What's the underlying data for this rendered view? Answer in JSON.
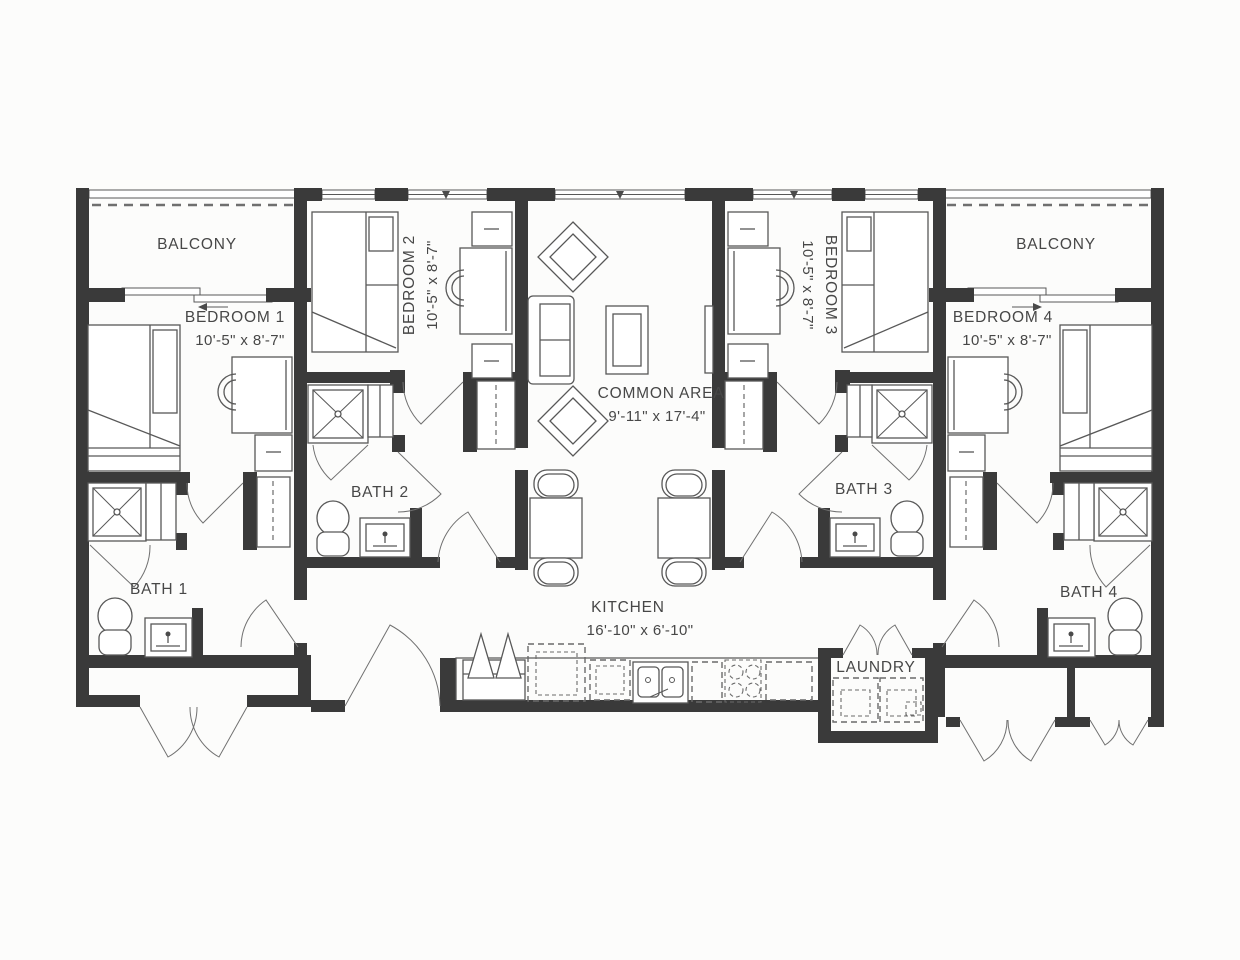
{
  "plan": {
    "title": "4-bedroom unit floor plan",
    "rooms": {
      "balcony_left": {
        "name": "BALCONY"
      },
      "balcony_right": {
        "name": "BALCONY"
      },
      "bedroom1": {
        "name": "BEDROOM 1",
        "dims": "10'-5\" x 8'-7\""
      },
      "bedroom2": {
        "name": "BEDROOM 2",
        "dims": "10'-5\" x 8'-7\""
      },
      "bedroom3": {
        "name": "BEDROOM 3",
        "dims": "10'-5\" x 8'-7\""
      },
      "bedroom4": {
        "name": "BEDROOM 4",
        "dims": "10'-5\" x 8'-7\""
      },
      "common_area": {
        "name": "COMMON AREA",
        "dims": "9'-11\" x 17'-4\""
      },
      "bath1": {
        "name": "BATH 1"
      },
      "bath2": {
        "name": "BATH 2"
      },
      "bath3": {
        "name": "BATH 3"
      },
      "bath4": {
        "name": "BATH 4"
      },
      "kitchen": {
        "name": "KITCHEN",
        "dims": "16'-10\" x 6'-10\""
      },
      "laundry": {
        "name": "LAUNDRY"
      }
    },
    "colors": {
      "wall": "#3a3a3a",
      "line": "#585858",
      "dash": "#6a6a6a",
      "text": "#474747",
      "bg": "#fcfcfb",
      "win": "#ffffff"
    }
  }
}
